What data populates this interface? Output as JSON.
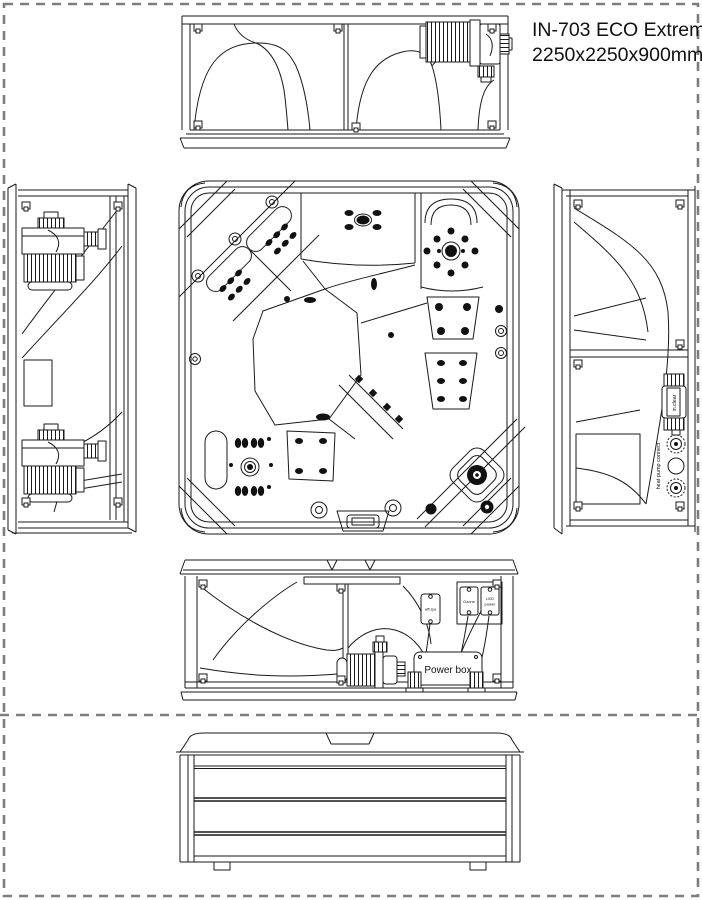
{
  "document": {
    "product_name": "IN-703 ECO Extreme",
    "dimensions": "2250x2250x900mm"
  },
  "equipment_labels": {
    "power_box": "Power box",
    "ozone": "Ozone",
    "led_line1": "LED",
    "led_line2": "power",
    "wifi_spa": "wifi spa",
    "in_clear": "in.clear",
    "heat_pump_connect": "heat pump connect"
  },
  "colors": {
    "line": "#1a1a1a",
    "page_border_dash": "#7e7e7e",
    "jet_fill": "#111111",
    "background": "#ffffff"
  }
}
